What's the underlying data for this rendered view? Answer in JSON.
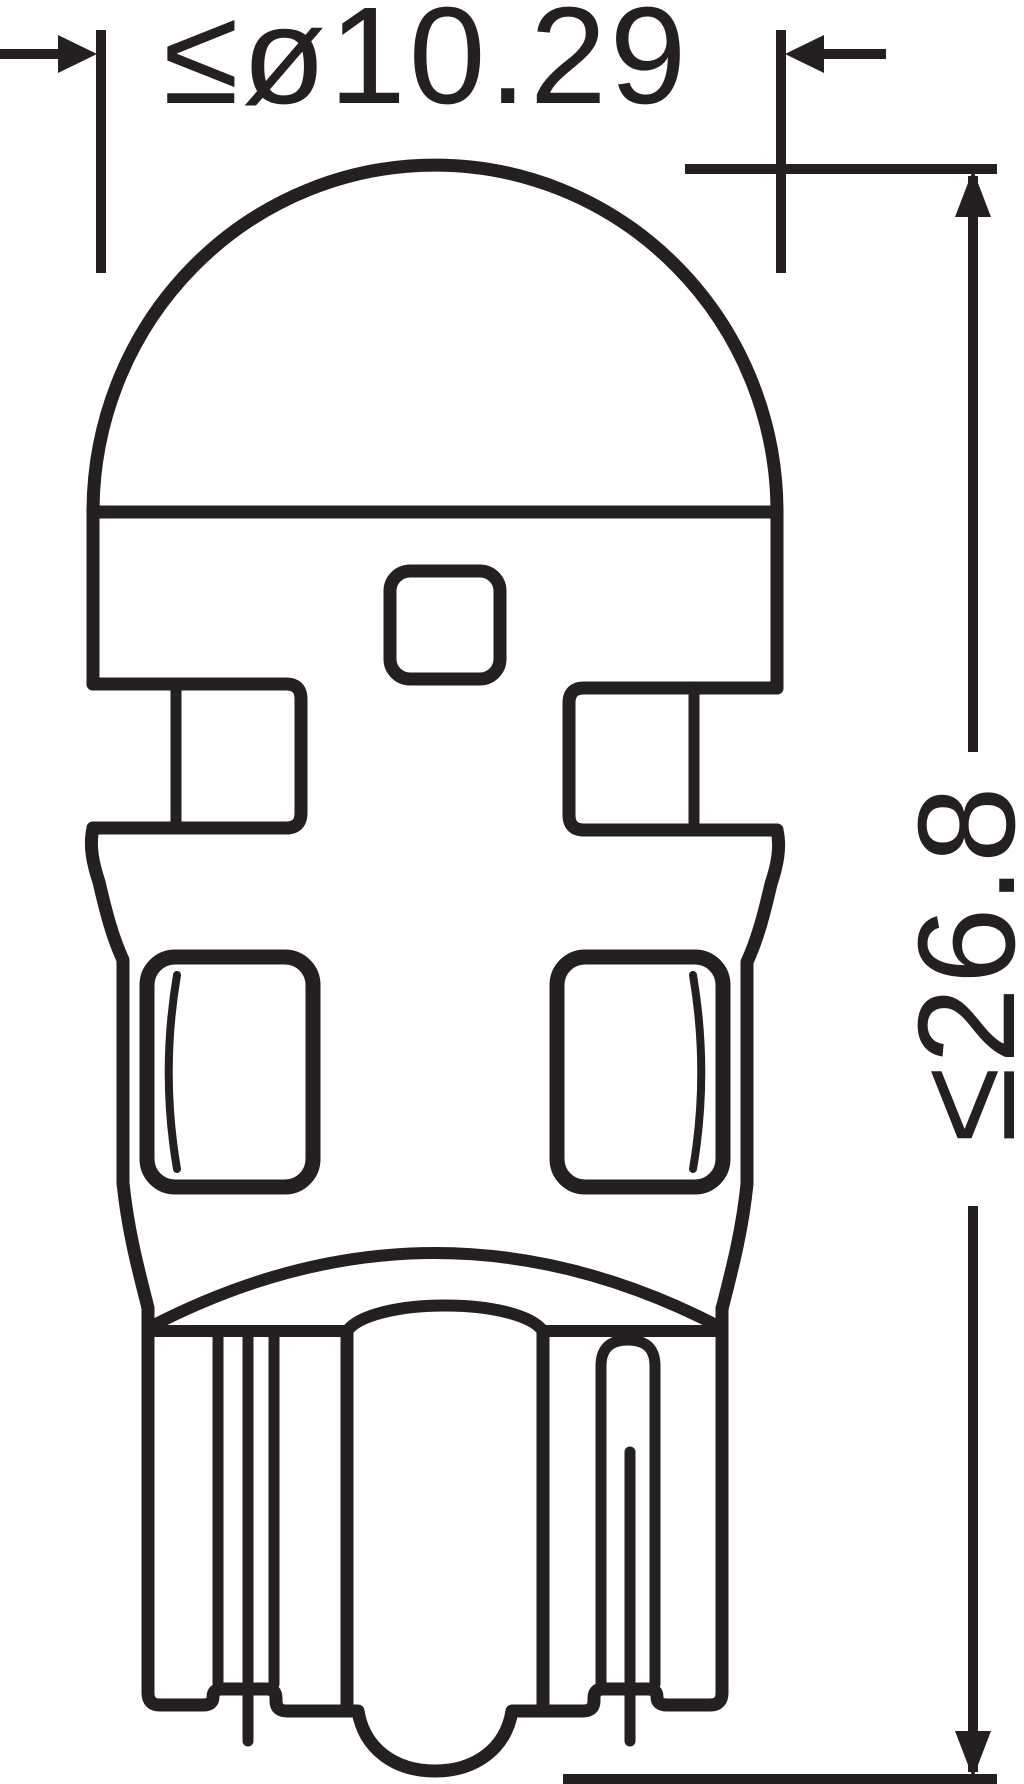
{
  "drawing": {
    "ink_color": "#241f20",
    "background_color": "#ffffff"
  },
  "dimensions": {
    "diameter": {
      "label": "≤ø10.29",
      "value": 10.29,
      "constraint": "max"
    },
    "height": {
      "label": "≤26.8",
      "value": 26.8,
      "constraint": "max"
    }
  }
}
